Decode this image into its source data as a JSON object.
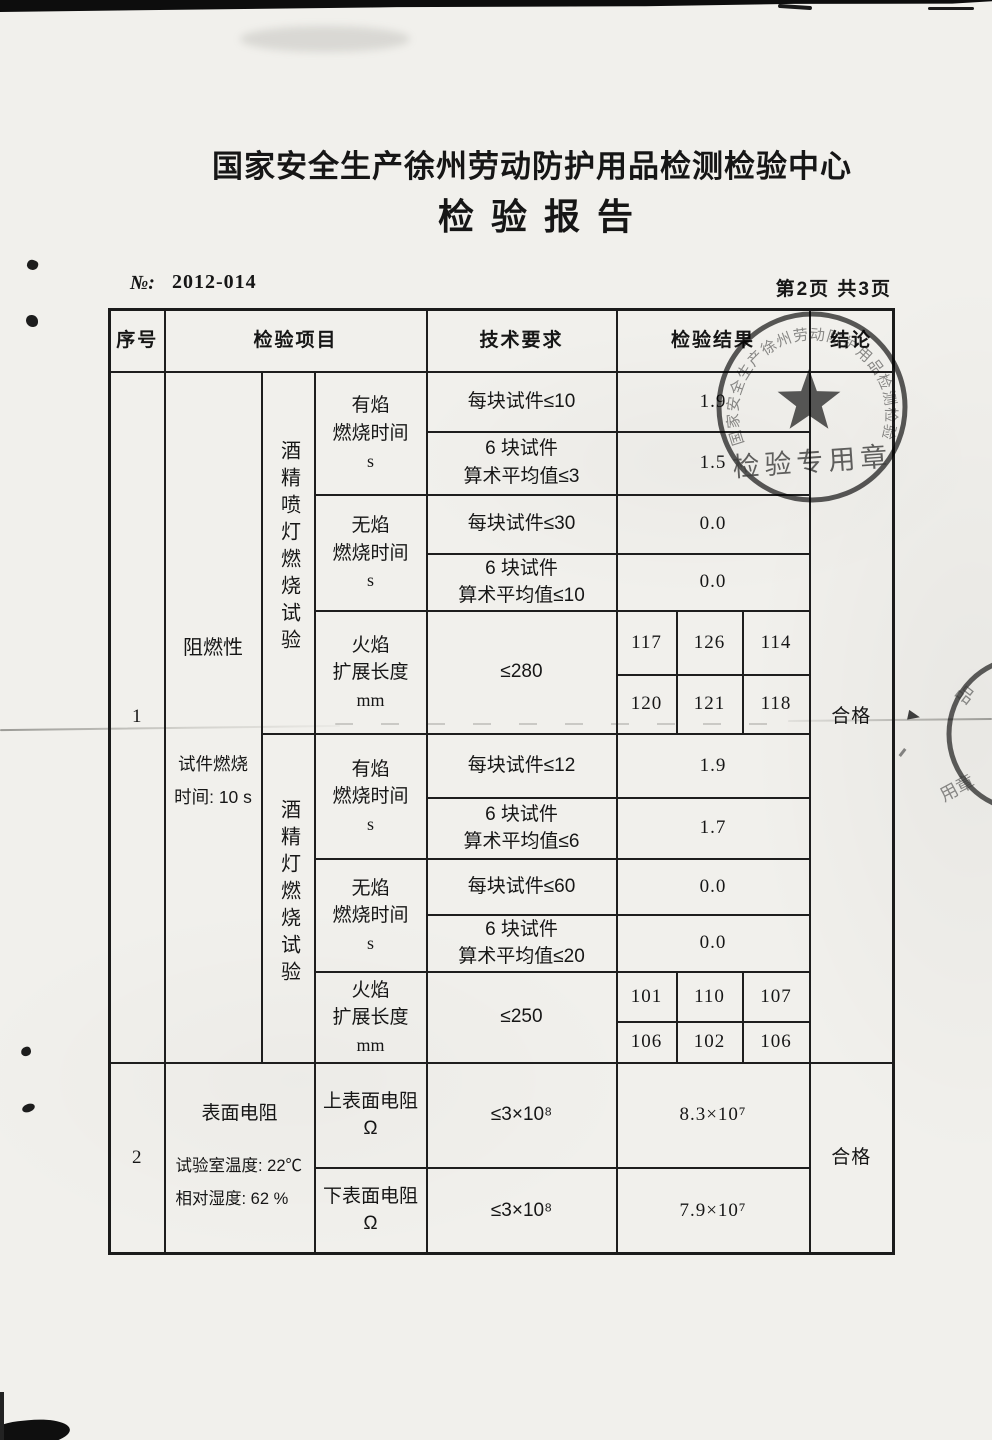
{
  "page": {
    "title": "国家安全生产徐州劳动防护用品检测检验中心",
    "subtitle": "检验报告",
    "no_label": "№:",
    "no_value": "2012-014",
    "page_indicator": "第2页 共3页"
  },
  "table": {
    "headers": {
      "seq": "序号",
      "item": "检验项目",
      "requirement": "技术要求",
      "result": "检验结果",
      "conclusion": "结论"
    },
    "section1": {
      "seq": "1",
      "item_name": "阻燃性",
      "item_note_line1": "试件燃烧",
      "item_note_line2": "时间: 10 s",
      "conclusion": "合格",
      "group1": {
        "name": "酒精喷灯燃烧试验",
        "flaming": {
          "label_line1": "有焰",
          "label_line2": "燃烧时间",
          "label_line3": "s",
          "req_single": "每块试件≤10",
          "req_avg_line1": "6 块试件",
          "req_avg_line2": "算术平均值≤3",
          "result_single": "1.9",
          "result_avg": "1.5"
        },
        "flameless": {
          "label_line1": "无焰",
          "label_line2": "燃烧时间",
          "label_line3": "s",
          "req_single": "每块试件≤30",
          "req_avg_line1": "6 块试件",
          "req_avg_line2": "算术平均值≤10",
          "result_single": "0.0",
          "result_avg": "0.0"
        },
        "spread": {
          "label_line1": "火焰",
          "label_line2": "扩展长度",
          "label_line3": "mm",
          "req": "≤280",
          "values_row1": [
            "117",
            "126",
            "114"
          ],
          "values_row2": [
            "120",
            "121",
            "118"
          ]
        }
      },
      "group2": {
        "name": "酒精灯燃烧试验",
        "flaming": {
          "label_line1": "有焰",
          "label_line2": "燃烧时间",
          "label_line3": "s",
          "req_single": "每块试件≤12",
          "req_avg_line1": "6 块试件",
          "req_avg_line2": "算术平均值≤6",
          "result_single": "1.9",
          "result_avg": "1.7"
        },
        "flameless": {
          "label_line1": "无焰",
          "label_line2": "燃烧时间",
          "label_line3": "s",
          "req_single": "每块试件≤60",
          "req_avg_line1": "6 块试件",
          "req_avg_line2": "算术平均值≤20",
          "result_single": "0.0",
          "result_avg": "0.0"
        },
        "spread": {
          "label_line1": "火焰",
          "label_line2": "扩展长度",
          "label_line3": "mm",
          "req": "≤250",
          "values_row1": [
            "101",
            "110",
            "107"
          ],
          "values_row2": [
            "106",
            "102",
            "106"
          ]
        }
      }
    },
    "section2": {
      "seq": "2",
      "item_name": "表面电阻",
      "item_note_line1": "试验室温度: 22℃",
      "item_note_line2": "相对湿度: 62 %",
      "conclusion": "合格",
      "row_top": {
        "label_line1": "上表面电阻",
        "label_line2": "Ω",
        "req": "≤3×10⁸",
        "result": "8.3×10⁷"
      },
      "row_bottom": {
        "label_line1": "下表面电阻",
        "label_line2": "Ω",
        "req": "≤3×10⁸",
        "result": "7.9×10⁷"
      }
    }
  },
  "stamp": {
    "arc_text": "国家安全生产徐州劳动防护用品检测检验中心",
    "bottom_text": "检验专用章"
  },
  "edge_stamp": {
    "top_chars": "品",
    "bottom_chars": "用章"
  },
  "colors": {
    "ink": "#161616",
    "stamp_ink": "#333333",
    "paper": "#f1f0ec"
  }
}
